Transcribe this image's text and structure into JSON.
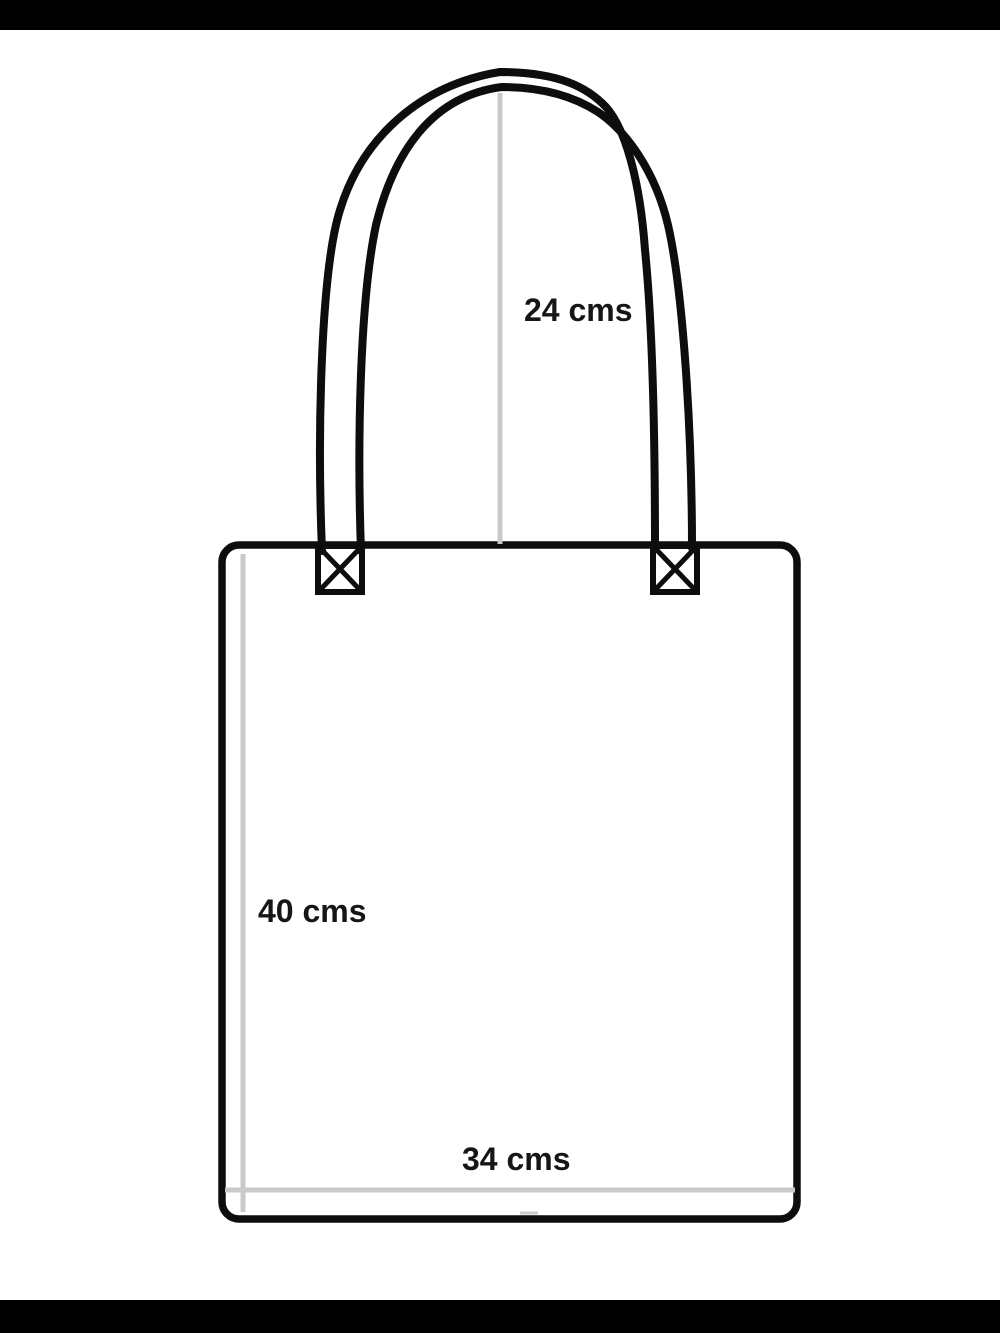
{
  "diagram": {
    "subject": "tote-bag-sewing-measurements",
    "measurements": {
      "handle_height": "24 cms",
      "bag_height": "40 cms",
      "bag_width": "34 cms"
    }
  },
  "colors": {
    "outline_black": "#0d0d0d",
    "guide_gray": "#c9c9c9",
    "label_text": "#161616",
    "background": "#ffffff",
    "letterbox": "#000000"
  }
}
